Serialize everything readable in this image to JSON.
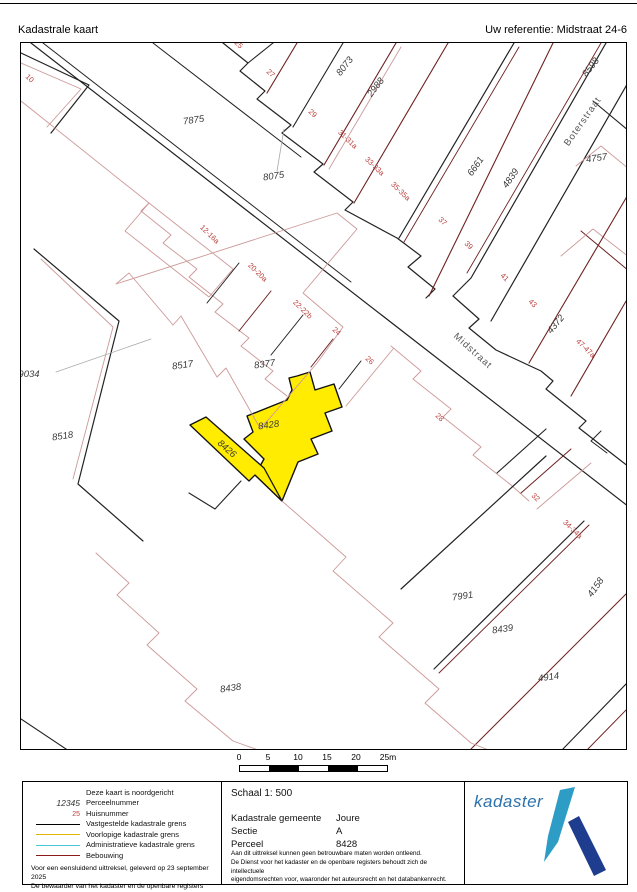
{
  "header": {
    "title": "Kadastrale kaart",
    "reference": "Uw referentie: Midstraat 24-6"
  },
  "map": {
    "highlight_color": "#ffec00",
    "boundary_color": "#222222",
    "building_color": "#6e2020",
    "building_light_color": "#cc9999",
    "house_number_color": "#b9403c",
    "parcel_text_color": "#3a3a3a",
    "labels": {
      "parcels": [
        {
          "t": "7875",
          "x": 193,
          "y": 122,
          "r": -8
        },
        {
          "t": "8075",
          "x": 273,
          "y": 178,
          "r": -8
        },
        {
          "t": "8073",
          "x": 346,
          "y": 67,
          "r": -52
        },
        {
          "t": "2988",
          "x": 377,
          "y": 88,
          "r": -52
        },
        {
          "t": "8598",
          "x": 592,
          "y": 68,
          "r": -52
        },
        {
          "t": "4757",
          "x": 596,
          "y": 160,
          "r": -8
        },
        {
          "t": "6661",
          "x": 477,
          "y": 167,
          "r": -55
        },
        {
          "t": "4839",
          "x": 512,
          "y": 179,
          "r": -55
        },
        {
          "t": "4372",
          "x": 557,
          "y": 325,
          "r": -50
        },
        {
          "t": "9034",
          "x": 28,
          "y": 376,
          "r": 0
        },
        {
          "t": "8517",
          "x": 182,
          "y": 367,
          "r": -8
        },
        {
          "t": "8377",
          "x": 264,
          "y": 366,
          "r": -8
        },
        {
          "t": "8518",
          "x": 62,
          "y": 438,
          "r": -8
        },
        {
          "t": "8426",
          "x": 224,
          "y": 450,
          "r": 41
        },
        {
          "t": "8428",
          "x": 268,
          "y": 427,
          "r": -8
        },
        {
          "t": "8438",
          "x": 230,
          "y": 690,
          "r": -8
        },
        {
          "t": "7991",
          "x": 462,
          "y": 598,
          "r": -8
        },
        {
          "t": "8439",
          "x": 502,
          "y": 631,
          "r": -8
        },
        {
          "t": "4914",
          "x": 548,
          "y": 679,
          "r": -8
        },
        {
          "t": "4158",
          "x": 597,
          "y": 588,
          "r": -55
        }
      ],
      "houses": [
        {
          "t": "10",
          "x": 27,
          "y": 79
        },
        {
          "t": "25",
          "x": 236,
          "y": 45
        },
        {
          "t": "27",
          "x": 268,
          "y": 74
        },
        {
          "t": "29",
          "x": 310,
          "y": 114
        },
        {
          "t": "31-31a",
          "x": 345,
          "y": 140
        },
        {
          "t": "33-33a",
          "x": 372,
          "y": 167
        },
        {
          "t": "35-35a",
          "x": 398,
          "y": 192
        },
        {
          "t": "37",
          "x": 440,
          "y": 222
        },
        {
          "t": "39",
          "x": 466,
          "y": 246
        },
        {
          "t": "41",
          "x": 502,
          "y": 278
        },
        {
          "t": "43",
          "x": 530,
          "y": 304
        },
        {
          "t": "47-47a",
          "x": 583,
          "y": 349
        },
        {
          "t": "12-16a",
          "x": 207,
          "y": 235
        },
        {
          "t": "20-20a",
          "x": 255,
          "y": 273
        },
        {
          "t": "22-22b",
          "x": 300,
          "y": 310
        },
        {
          "t": "24",
          "x": 334,
          "y": 332
        },
        {
          "t": "26",
          "x": 367,
          "y": 361
        },
        {
          "t": "28",
          "x": 437,
          "y": 418
        },
        {
          "t": "32",
          "x": 533,
          "y": 498
        },
        {
          "t": "34-34a",
          "x": 570,
          "y": 530
        }
      ],
      "streets": [
        {
          "t": "Midstraat",
          "x": 470,
          "y": 352,
          "r": 42
        },
        {
          "t": "Boterstraat",
          "x": 584,
          "y": 122,
          "r": -55
        }
      ]
    }
  },
  "scale_bar": {
    "ticks": [
      "0",
      "5",
      "10",
      "15",
      "20",
      "25m"
    ]
  },
  "legend": {
    "rows": [
      {
        "sym": "none",
        "label": "Deze kaart is noordgericht"
      },
      {
        "sym": "parcel",
        "symtext": "12345",
        "label": "Perceelnummer"
      },
      {
        "sym": "house",
        "symtext": "25",
        "label": "Huisnummer"
      },
      {
        "sym": "line-black",
        "label": "Vastgestelde kadastrale grens"
      },
      {
        "sym": "line-yellow",
        "label": "Voorlopige kadastrale grens"
      },
      {
        "sym": "line-cyan",
        "label": "Administratieve kadastrale grens"
      },
      {
        "sym": "line-darkred",
        "label": "Bebouwing"
      }
    ],
    "line_colors": {
      "black": "#000000",
      "yellow": "#e0b400",
      "cyan": "#49c8d8",
      "darkred": "#8b1a1a"
    },
    "footer_line1": "Voor een eensluidend uittreksel, geleverd op 23 september 2025",
    "footer_line2": "De bewaarder van het kadaster en de openbare registers"
  },
  "info": {
    "schaal": "Schaal 1: 500",
    "rows": [
      {
        "label": "Kadastrale gemeente",
        "value": "Joure"
      },
      {
        "label": "Sectie",
        "value": "A"
      },
      {
        "label": "Perceel",
        "value": "8428"
      }
    ],
    "disclaimer": [
      "Aan dit uittreksel kunnen geen betrouwbare maten worden ontleend.",
      "De Dienst voor het kadaster en de openbare registers behoudt zich de intellectuele",
      "eigendomsrechten voor, waaronder het auteursrecht en het databankenrecht."
    ]
  },
  "logo": {
    "word": "kadaster",
    "word_color": "#2c72ad",
    "mark_light": "#2e9dc6",
    "mark_dark": "#1e3d8f"
  }
}
